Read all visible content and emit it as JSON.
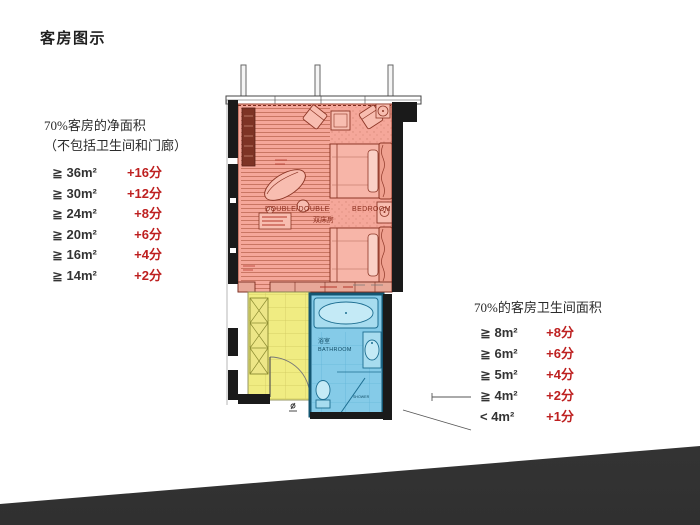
{
  "slide": {
    "title": "客房图示"
  },
  "left_panel": {
    "heading_line1": "70%客房的净面积",
    "heading_line2": "（不包括卫生间和门廊）",
    "items": [
      {
        "condition": "≧ 36m²",
        "score": "+16分"
      },
      {
        "condition": "≧ 30m²",
        "score": "+12分"
      },
      {
        "condition": "≧ 24m²",
        "score": "+8分"
      },
      {
        "condition": "≧ 20m²",
        "score": "+6分"
      },
      {
        "condition": "≧ 16m²",
        "score": "+4分"
      },
      {
        "condition": "≧ 14m²",
        "score": "+2分"
      }
    ]
  },
  "right_panel": {
    "heading": "70%的客房卫生间面积",
    "items": [
      {
        "condition": "≧ 8m²",
        "score": "+8分"
      },
      {
        "condition": "≧ 6m²",
        "score": "+6分"
      },
      {
        "condition": "≧ 5m²",
        "score": "+4分"
      },
      {
        "condition": "≧ 4m²",
        "score": "+2分"
      },
      {
        "condition": "< 4m²",
        "score": "+1分"
      }
    ]
  },
  "floorplan": {
    "bedroom_label_en1": "DOUBLE/DOUBLE",
    "bedroom_label_en2": "BEDROOM",
    "bedroom_label_cn": "双床房",
    "bathroom_label_cn": "浴室",
    "bathroom_label_en": "BATHROOM",
    "shower_label": "SHOWER",
    "zones": [
      {
        "name": "bedroom",
        "color": "#F5A79A"
      },
      {
        "name": "entry-corridor",
        "color": "#F0EC82"
      },
      {
        "name": "bathroom",
        "color": "#85CBE8"
      }
    ]
  },
  "colors": {
    "score_red": "#BE2020",
    "text_dark": "#2B2B2B",
    "footer_band": "#3C3C3C"
  }
}
